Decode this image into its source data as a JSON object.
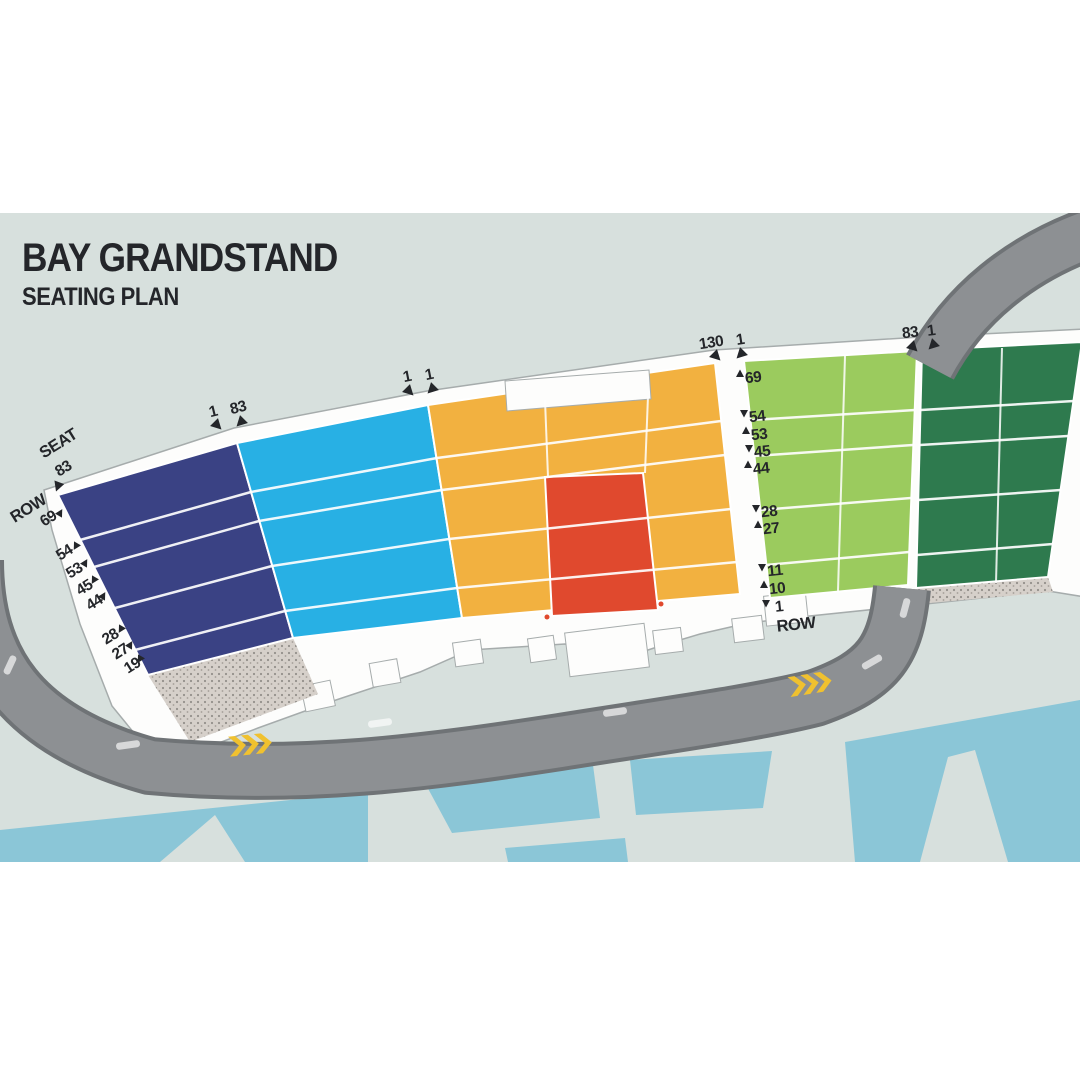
{
  "title": {
    "main": "BAY GRANDSTAND",
    "subtitle": "SEATING PLAN"
  },
  "colors": {
    "page_bg": "#ffffff",
    "map_bg": "#d7e0dd",
    "water": "#8bc6d7",
    "road": "#8d9093",
    "road_edge": "#6f7376",
    "walkway": "#fdfdfc",
    "walkway_edge": "#a6acac",
    "navy": "#3a4284",
    "cyan": "#28b0e4",
    "orange": "#f2b140",
    "red": "#e0492e",
    "light_green": "#9bcb5e",
    "dark_green": "#2e7a4e",
    "chevron": "#f0c12f",
    "text": "#24262a"
  },
  "left_axis": {
    "seat_label": "SEAT",
    "seat_number": "83",
    "row_label": "ROW",
    "rows": [
      "69",
      "54",
      "53",
      "45",
      "44",
      "28",
      "27",
      "19"
    ]
  },
  "right_axis": {
    "rows": [
      "69",
      "54",
      "53",
      "45",
      "44",
      "28",
      "27",
      "11",
      "10",
      "1"
    ],
    "row_label": "ROW"
  },
  "boundaries": [
    {
      "left": "1",
      "right": "83"
    },
    {
      "left": "1",
      "right": "1"
    },
    {
      "left": "130",
      "right": "1"
    },
    {
      "left": "83",
      "right": "1"
    }
  ],
  "sections": [
    {
      "id": "navy-stand"
    },
    {
      "id": "cyan-stand"
    },
    {
      "id": "orange-stand"
    },
    {
      "id": "red-stand"
    },
    {
      "id": "light-green-stand"
    },
    {
      "id": "dark-green-stand"
    }
  ]
}
